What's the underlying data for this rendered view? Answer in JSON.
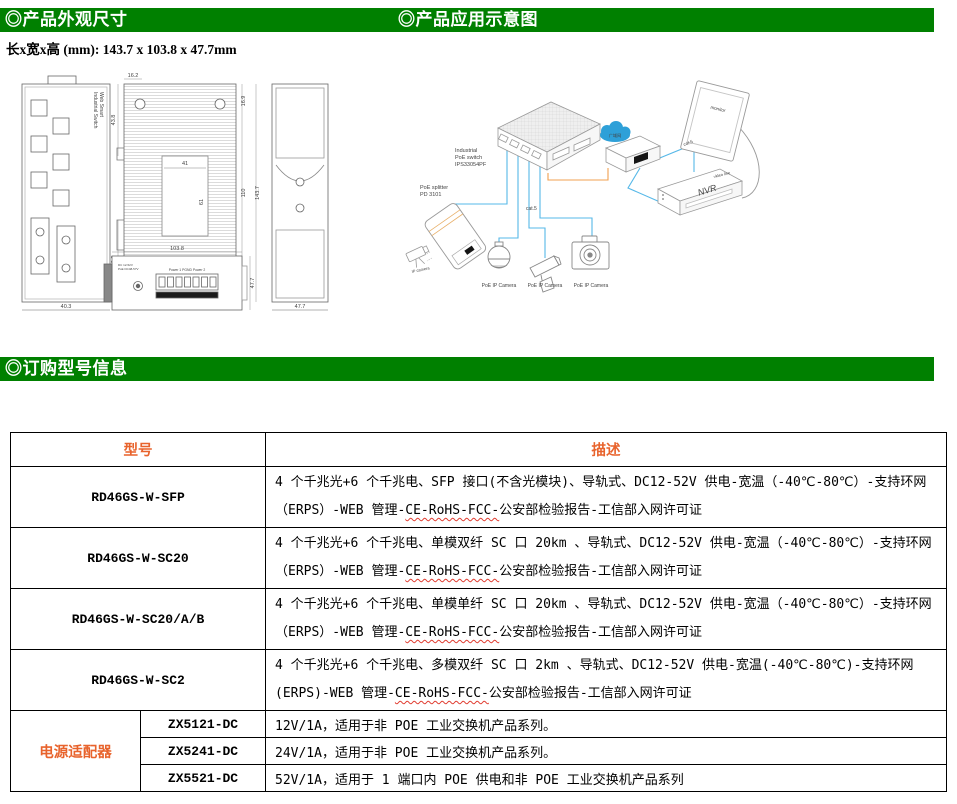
{
  "colors": {
    "accent_green": "#008000",
    "accent_orange": "#E8632C",
    "cat5_blue": "#56B8E8",
    "power_orange": "#F0A050",
    "cloud_blue": "#2EA0D8"
  },
  "headers": {
    "section1": "◎产品外观尺寸",
    "section2": "◎产品应用示意图",
    "section3": "◎订购型号信息"
  },
  "dimensions_line": "长x宽x高 (mm): 143.7 x 103.8 x 47.7mm",
  "drawing": {
    "front_label_1": "Web Smart",
    "front_label_2": "Industrial Switch",
    "dims": {
      "front_width": "40.3",
      "side_top": "16.2",
      "side_left_upper": "43.8",
      "side_left_lower": "52.9",
      "inner_width": "41",
      "inner_height": "61",
      "right_top": "16.9",
      "right_mid": "110",
      "right_bottom": "16.9",
      "total_height": "143.7",
      "back_width": "47.7",
      "bottom_width": "103.8",
      "bottom_height": "47.7"
    },
    "labels": {
      "supply1": "DC 12-52V",
      "supply2": "PoE DC48-57V",
      "power_terminals": "Power 1   PGND   Power 2"
    }
  },
  "diagram": {
    "switch_label_1": "Industrial",
    "switch_label_2": "PoE switch",
    "switch_label_3": "IPS33054PF",
    "splitter_label_1": "PoE splitter",
    "splitter_label_2": "PD 3101",
    "ip_camera": "IP camera",
    "cat5_left": "cat.5",
    "cat5_right": "cat.5",
    "video_line": "video line",
    "cloud": "广域网",
    "nvr": "NVR",
    "monitor": "monitor",
    "cam1": "PoE IP Camera",
    "cam2": "PoE IP Camera",
    "cam3": "PoE IP Camera"
  },
  "table": {
    "headers": {
      "model": "型号",
      "desc": "描述"
    },
    "rows": [
      {
        "model": "RD46GS-W-SFP",
        "desc_pre": "4 个千兆光+6 个千兆电、SFP 接口(不含光模块)、导轨式、DC12-52V 供电-宽温（-40℃-80℃）-支持环网（ERPS）-WEB 管理-",
        "desc_wavy": "CE-RoHS-FCC-",
        "desc_post": "公安部检验报告-工信部入网许可证"
      },
      {
        "model": "RD46GS-W-SC20",
        "desc_pre": "4 个千兆光+6 个千兆电、单模双纤 SC 口 20km 、导轨式、DC12-52V 供电-宽温（-40℃-80℃）-支持环网（ERPS）-WEB 管理-",
        "desc_wavy": "CE-RoHS-FCC-",
        "desc_post": "公安部检验报告-工信部入网许可证"
      },
      {
        "model": "RD46GS-W-SC20/A/B",
        "desc_pre": "4 个千兆光+6 个千兆电、单模单纤 SC 口 20km 、导轨式、DC12-52V 供电-宽温（-40℃-80℃）-支持环网（ERPS）-WEB 管理-",
        "desc_wavy": "CE-RoHS-FCC-",
        "desc_post": "公安部检验报告-工信部入网许可证"
      },
      {
        "model": "RD46GS-W-SC2",
        "desc_pre": "4 个千兆光+6 个千兆电、多模双纤 SC 口 2km 、导轨式、DC12-52V 供电-宽温(-40℃-80℃)-支持环网(ERPS)-WEB 管理-",
        "desc_wavy": "CE-RoHS-FCC-",
        "desc_post": "公安部检验报告-工信部入网许可证"
      }
    ],
    "adapter": {
      "label": "电源适配器",
      "rows": [
        {
          "model": "ZX5121-DC",
          "desc": "12V/1A，适用于非 POE 工业交换机产品系列。"
        },
        {
          "model": "ZX5241-DC",
          "desc": "24V/1A，适用于非 POE 工业交换机产品系列。"
        },
        {
          "model": "ZX5521-DC",
          "desc": "52V/1A，适用于 1 端口内 POE 供电和非 POE 工业交换机产品系列"
        }
      ]
    }
  }
}
